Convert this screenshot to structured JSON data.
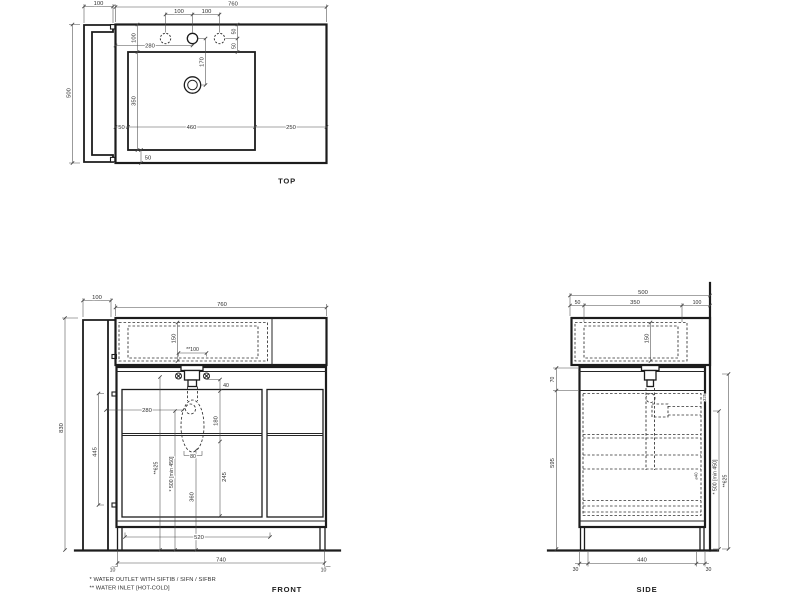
{
  "views": {
    "top": {
      "label": "TOP",
      "panel_width": "100",
      "total_width": "760",
      "total_depth": "500",
      "hole_pitch_left": "100",
      "hole_pitch_right": "100",
      "edge_to_basin": "100",
      "basin_depth": "350",
      "tap_from_left": "280",
      "tap_to_drain": "170",
      "hole_offset_upper": "50",
      "hole_offset_lower": "50",
      "basin_margin_left": "50",
      "basin_width": "460",
      "counter_right": "250",
      "basin_margin_bottom": "50"
    },
    "front": {
      "label": "FRONT",
      "panel_width": "100",
      "total_width": "760",
      "basin_inner_depth": "150",
      "inlet_spacing": "**100",
      "inlet_drop": "40",
      "trap_from_left": "280",
      "drain_drop": "180",
      "overall_height": "830",
      "hinge_spacing": "445",
      "inlet_height": "**625",
      "outlet_height": "* 500 [min 450]",
      "trap_height": "360",
      "drop_to_bottom": "245",
      "trap_width": "80",
      "plinth_width": "520",
      "base_width": "740",
      "base_inset_left": "10",
      "base_inset_right": "10"
    },
    "side": {
      "label": "SIDE",
      "total_depth": "500",
      "back_offset": "50",
      "basin_depth": "350",
      "front_offset": "100",
      "basin_inner_depth": "150",
      "counter_gap": "70",
      "cabinet_height": "595",
      "outlet_height": "* 500 [min 450]",
      "inlet_height": "**625",
      "pipe_detail_upper": "325",
      "pipe_detail_lower": "⌀40",
      "foot_back": "30",
      "base_depth": "440",
      "foot_front": "30"
    }
  },
  "footnotes": {
    "outlet": "*  WATER OUTLET WITH SIFTIB / SIFN / SIFBR",
    "inlet": "** WATER INLET [HOT-COLD]"
  }
}
